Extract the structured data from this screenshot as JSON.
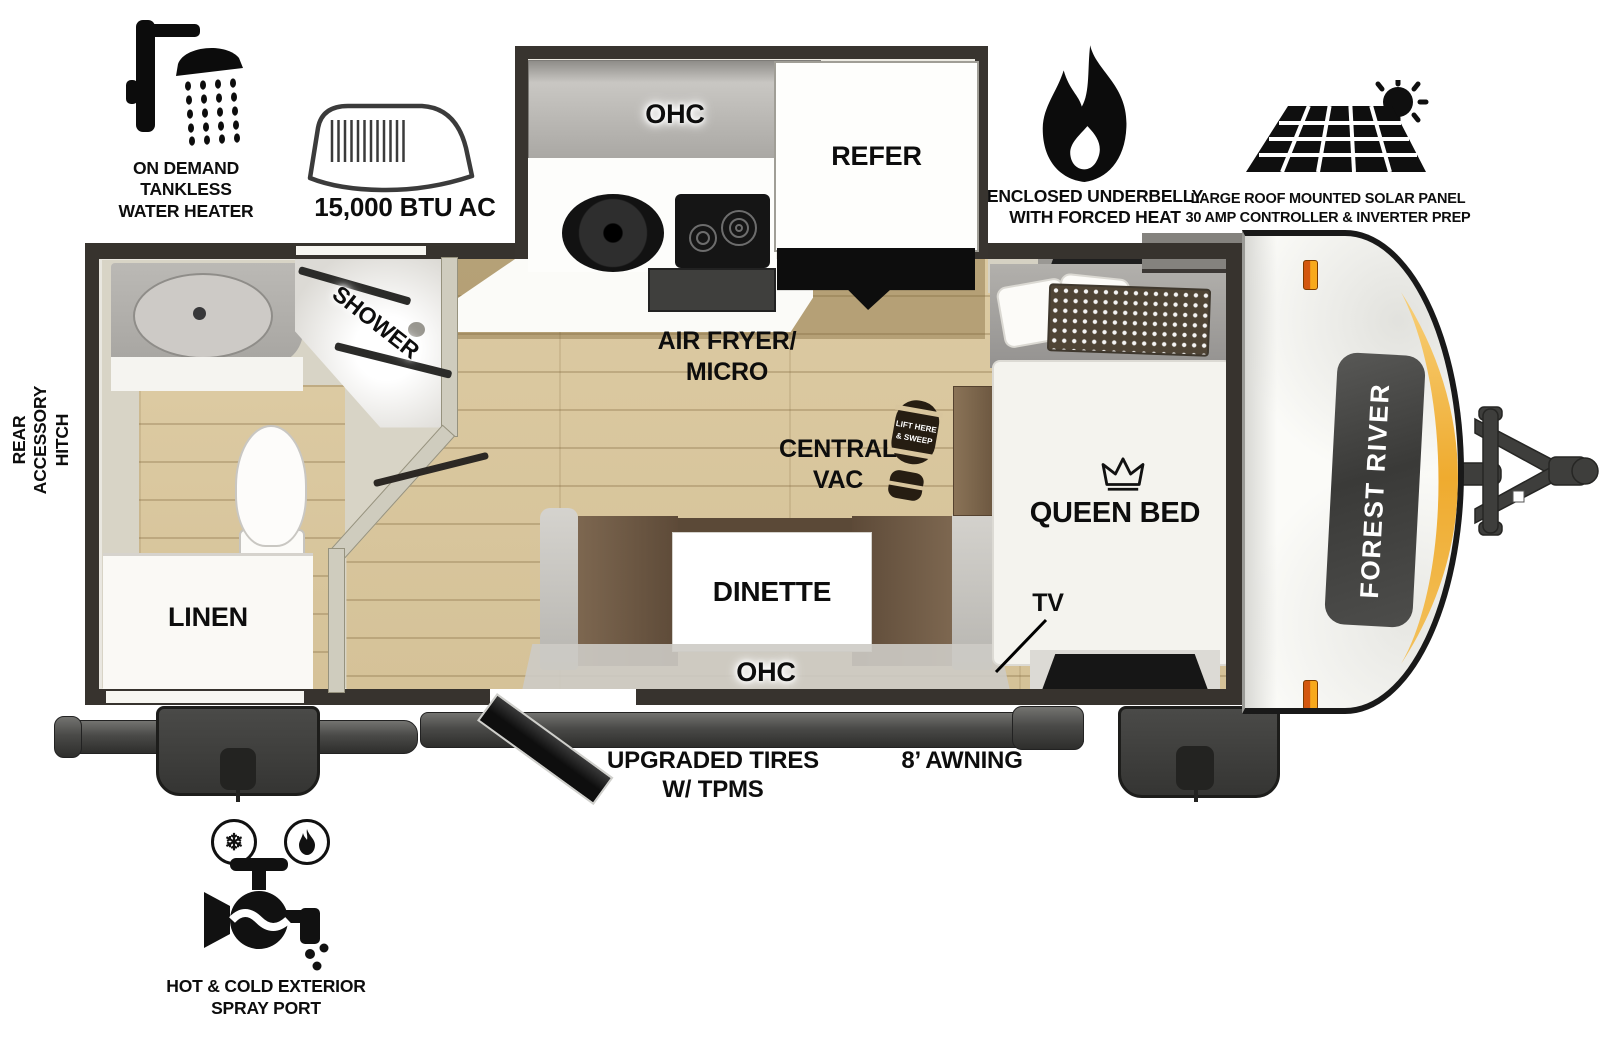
{
  "features_top": [
    {
      "icon": "shower-head-icon",
      "label": "ON DEMAND\nTANKLESS\nWATER HEATER"
    },
    {
      "icon": "ac-unit-icon",
      "label": "15,000 BTU AC"
    },
    {
      "icon": "flame-icon",
      "label": "ENCLOSED UNDERBELLY\nWITH FORCED HEAT"
    },
    {
      "icon": "solar-panel-icon",
      "label": "LARGE ROOF MOUNTED SOLAR PANEL\n30 AMP CONTROLLER & INVERTER PREP"
    }
  ],
  "floorplan": {
    "slide": {
      "ohc": "OHC",
      "refer": "REFER"
    },
    "labels": {
      "air_fryer_micro": "AIR FRYER/\nMICRO",
      "central_vac": "CENTRAL\nVAC",
      "boot_print_line1": "LIFT HERE",
      "boot_print_line2": "& SWEEP",
      "shower": "SHOWER",
      "linen": "LINEN",
      "dinette": "DINETTE",
      "ohc_lower": "OHC",
      "queen_bed": "QUEEN BED",
      "tv": "TV"
    }
  },
  "exterior": {
    "rear_accessory_hitch": "REAR\nACCESSORY\nHITCH",
    "upgraded_tires": "UPGRADED TIRES\nW/ TPMS",
    "awning": "8’ AWNING",
    "spray_port": "HOT & COLD EXTERIOR\nSPRAY PORT",
    "brand": "FOREST RIVER"
  },
  "colors": {
    "wall_dark": "#37332e",
    "wall_greige": "#cfccbe",
    "floor_wood": "#dbc9a2",
    "glow_orange": "#f0ae38",
    "marker_light": "#f08a1d",
    "cushion_brown": "#6f5a44",
    "appliance_black": "#141414",
    "chassis_gray": "#3e3e3c"
  }
}
